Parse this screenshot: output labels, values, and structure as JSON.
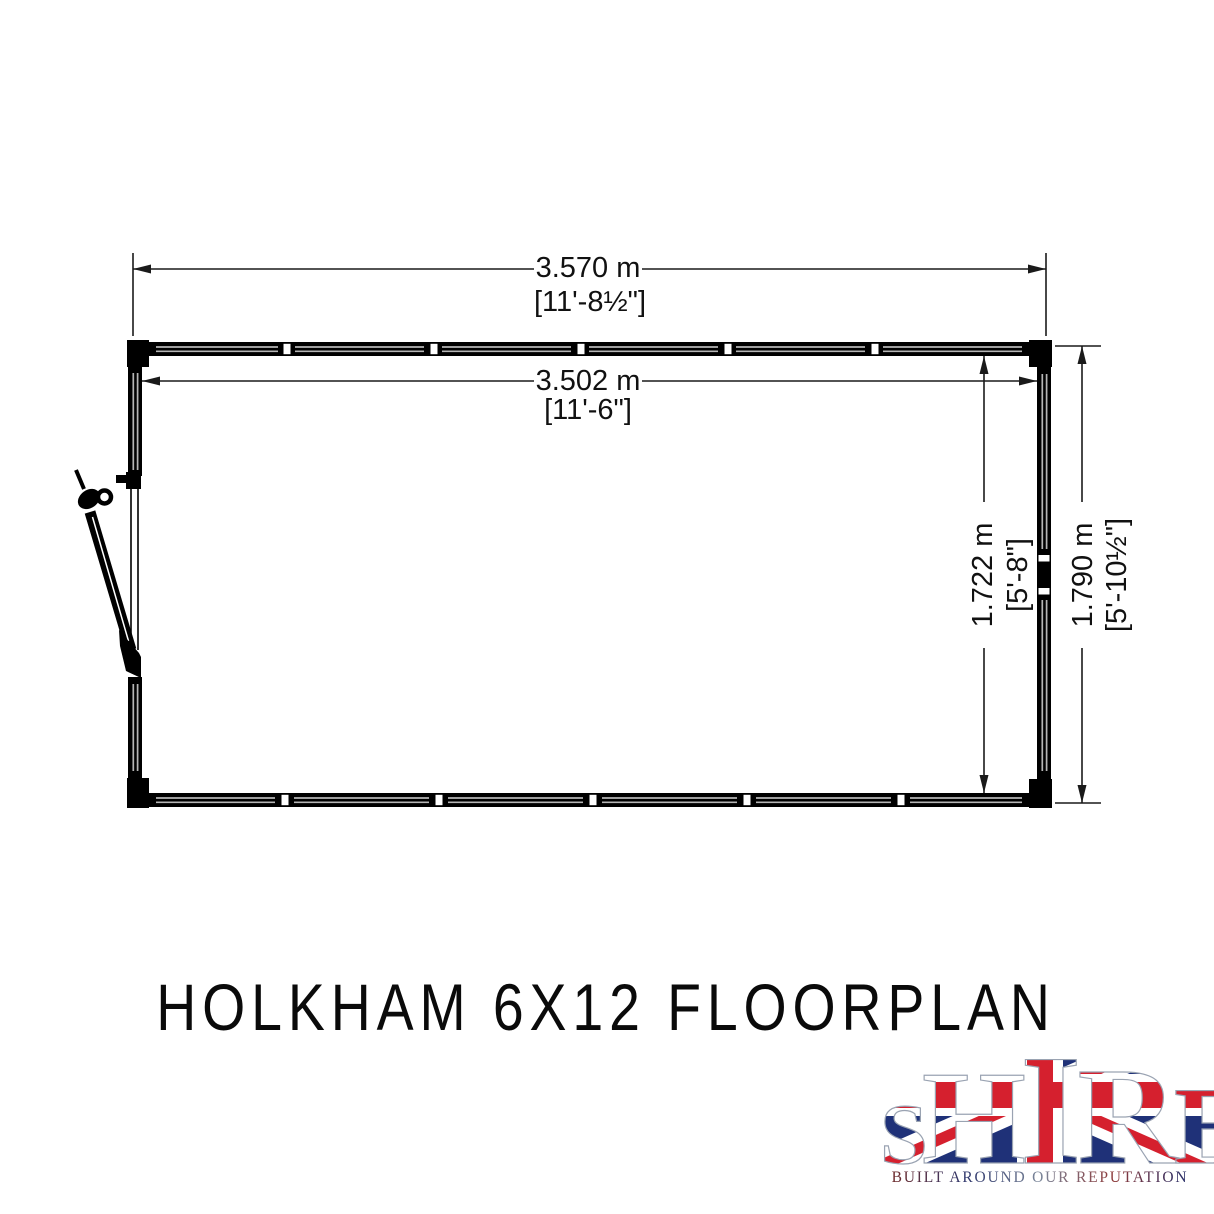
{
  "title": "HOLKHAM 6X12 FLOORPLAN",
  "floorplan": {
    "dimensions": {
      "outer_width": {
        "metric": "3.570 m",
        "imperial": "[11'-8½\"]"
      },
      "inner_width": {
        "metric": "3.502 m",
        "imperial": "[11'-6\"]"
      },
      "inner_depth": {
        "metric": "1.722 m",
        "imperial": "[5'-8\"]"
      },
      "outer_depth": {
        "metric": "1.790 m",
        "imperial": "[5'-10½\"]"
      }
    }
  },
  "logo": {
    "letters": [
      "S",
      "H",
      "I",
      "R",
      "E"
    ],
    "tagline": "BUILT AROUND OUR REPUTATION",
    "colors": {
      "flag_red": "#d5202e",
      "flag_blue": "#1f3178",
      "flag_white": "#ffffff"
    }
  },
  "drawing": {
    "line_color": "#000000"
  }
}
